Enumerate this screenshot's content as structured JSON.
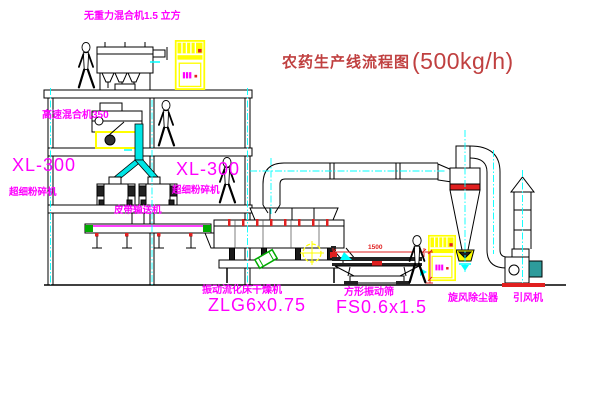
{
  "title": {
    "text": "农药生产线流程图",
    "capacity": "(500kg/h)"
  },
  "labels": {
    "gravity_mixer": "无重力混合机1.5 立方",
    "high_speed_mixer": "高速混合机350",
    "pulverizer_left_model": "XL-300",
    "pulverizer_left_name": "超细粉碎机",
    "pulverizer_center_model": "XL-300",
    "pulverizer_center_name": "超细粉碎机",
    "belt_conveyor": "皮带输送机",
    "dryer_name": "振动流化床干燥机",
    "dryer_model": "ZLG6x0.75",
    "sieve_name": "方形振动筛",
    "sieve_model": "FS0.6x1.5",
    "cyclone": "旋风除尘器",
    "fan": "引风机"
  },
  "dimensions": {
    "sieve_width": "1500"
  },
  "colors": {
    "label_magenta": "#FF00FF",
    "title_red": "#C04040",
    "equipment_yellow": "#FFFF00",
    "centerline_cyan": "#00FFFF",
    "accent_red": "#E02020",
    "accent_green": "#00AA00",
    "motor_teal": "#2E9B9B"
  }
}
